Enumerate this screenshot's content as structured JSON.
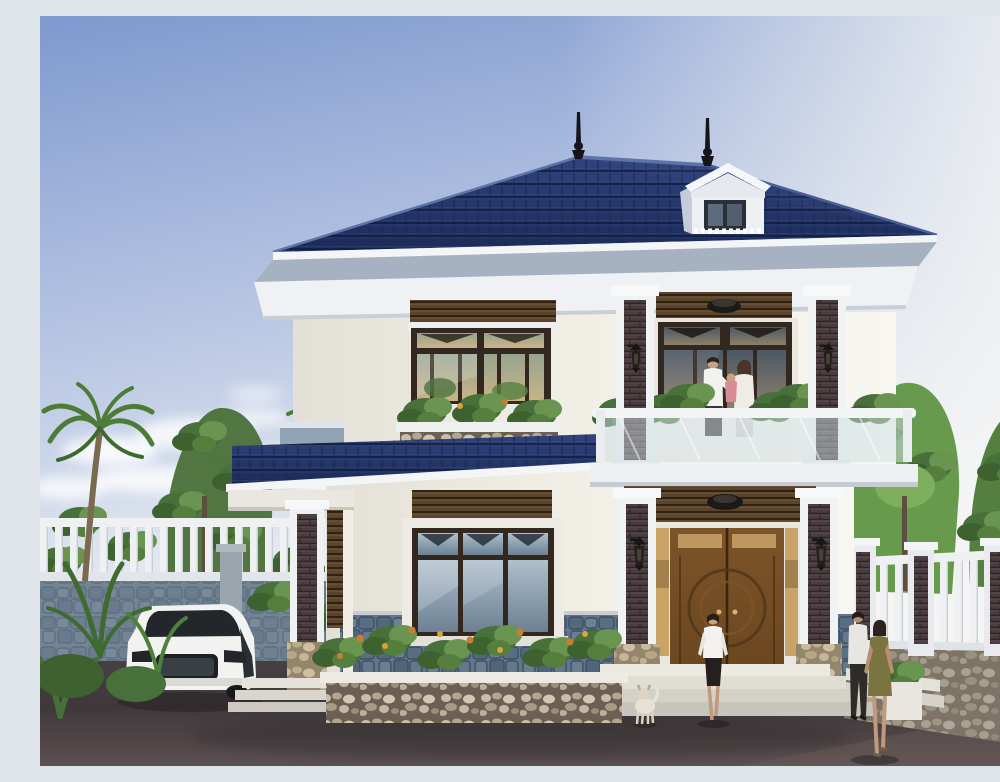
{
  "scene": {
    "type": "3d-architectural-exterior-render",
    "description": "Photorealistic daytime rendering of a modern two-story villa: navy-blue tiled hip roof with finial spires and a white dormer, cream walls, dark wood windows, a glass-railed balcony where a couple holds a child, carved wooden double entry door flanked by stone-clad pillars with lanterns, blue-grey stone wainscot, flower beds, white picket fences, palm trees, a parked white sedan, a woman walking to the door, a small dog, and a couple strolling at right on dark paving.",
    "time_of_day": "day",
    "labels": {
      "sky": "blue sky with soft clouds",
      "house": "two-story villa",
      "roof": "navy tiled hip roof",
      "dormer": "white roof dormer window",
      "balcony": "second-floor balcony with glass railing",
      "family": "couple holding a child on balcony",
      "front_door": "carved wooden double entry door",
      "upper_window": "upper-floor wood-framed window",
      "lower_window": "ground-floor wood-framed window",
      "car": "white sedan parked in driveway",
      "left_fence": "white picket fence on stone base (left)",
      "right_fence": "white slat fence with brick posts (right)",
      "palms": "palm trees",
      "flower_bed": "stone planter flower bed",
      "visitor": "woman walking toward entrance",
      "dog": "small white dog",
      "couple_right": "man and woman walking at right",
      "ground": "dark paved front yard",
      "trees": "green garden trees"
    }
  },
  "palette": {
    "sky_top": "#7e99cf",
    "sky_mid": "#bcc9e4",
    "sky_low": "#eef1f4",
    "roof": "#24356b",
    "roof_dark": "#1b2a57",
    "roof_light": "#3d5490",
    "fascia": "#f3f5f7",
    "soffit": "#a6b2c2",
    "cornice": "#eff1f4",
    "wall": "#f1eee6",
    "wall_bright": "#f8f6f0",
    "frame_dark": "#32281f",
    "slat_wood": "#5a442e",
    "brick_inlay": "#4a3c3f",
    "stone_wainscot": "#62768b",
    "pebble": "#6b6053",
    "stone_tan": "#c8b68e",
    "door_wood": "#6a451f",
    "sidelight": "#c9a368",
    "railing_glass": "rgba(205,222,228,0.5)",
    "ground": "#3f383a",
    "ground_light": "#5c5052",
    "fence_white": "#eef0f2",
    "green_dark": "#3e6130",
    "green": "#567f3e",
    "green_light": "#77a250",
    "flower_orange": "#c97f2e",
    "car_white": "#f2f2f0",
    "lamp_black": "#1c1a18",
    "skin": "#caa183",
    "dress_olive": "#7a7440",
    "child_pink": "#d98a96"
  }
}
